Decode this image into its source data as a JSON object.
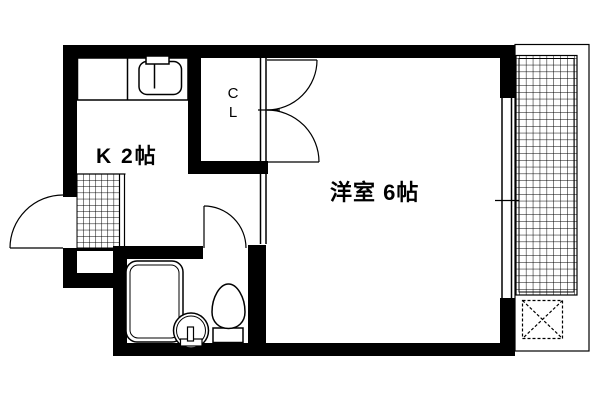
{
  "floorplan": {
    "labels": {
      "kitchen": "K 2帖",
      "closet": "C\nL",
      "western_room": "洋室 6帖"
    },
    "colors": {
      "wall": "#000000",
      "background": "#ffffff",
      "line": "#000000"
    },
    "fixtures": [
      "kitchen-sink-icon",
      "faucet-icon",
      "bathtub-icon",
      "wash-basin-icon",
      "toilet-icon",
      "entrance-door-swing-icon",
      "bathroom-door-swing-icon",
      "closet-double-door-icon",
      "sliding-window-icon",
      "genkan-tile-hatch",
      "balcony-deck-hatch",
      "dashed-x-marker"
    ]
  }
}
